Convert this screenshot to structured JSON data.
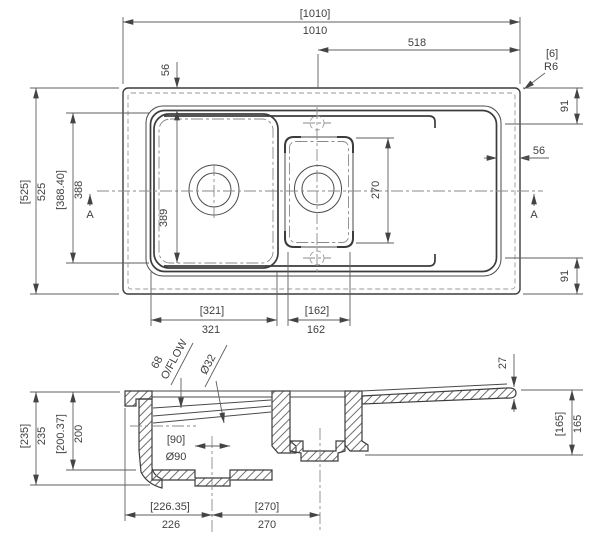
{
  "drawing": {
    "type": "technical-drawing",
    "subject": "inset kitchen sink, 1.5 bowl with drainer, plan and section views",
    "units": "mm",
    "ink_color": "#3c3c3c",
    "background": "#ffffff"
  },
  "plan": {
    "overall_width_aux": "[1010]",
    "overall_width": "1010",
    "drainer_span": "518",
    "corner_radius_aux": "[6]",
    "corner_radius": "R6",
    "edge_inset_top": "56",
    "edge_inset_right": "56",
    "margin_top_right": "91",
    "margin_bottom_right": "91",
    "overall_depth_aux": "[525]",
    "overall_depth": "525",
    "bowl_outer_depth_aux": "[388.40]",
    "bowl_outer_depth": "388",
    "bowl_inner_depth": "389",
    "half_bowl_depth": "270",
    "bowl_width_aux": "[321]",
    "bowl_width": "321",
    "half_bowl_width_aux": "[162]",
    "half_bowl_width": "162",
    "section_marker_left": "A",
    "section_marker_right": "A"
  },
  "section": {
    "overall_height_aux": "[235]",
    "overall_height": "235",
    "bowl_depth_aux": "[200.37]",
    "bowl_depth": "200",
    "overflow_height": "68",
    "overflow_label": "O/FLOW",
    "overflow_diameter": "Ø32",
    "waste_diameter_aux": "[90]",
    "waste_diameter": "Ø90",
    "rim_thickness": "27",
    "half_bowl_depth_aux": "[165]",
    "half_bowl_depth": "165",
    "bowl_centre_from_edge_aux": "[226.35]",
    "bowl_centre_from_edge": "226",
    "bowl_centre_spacing_aux": "[270]",
    "bowl_centre_spacing": "270"
  }
}
